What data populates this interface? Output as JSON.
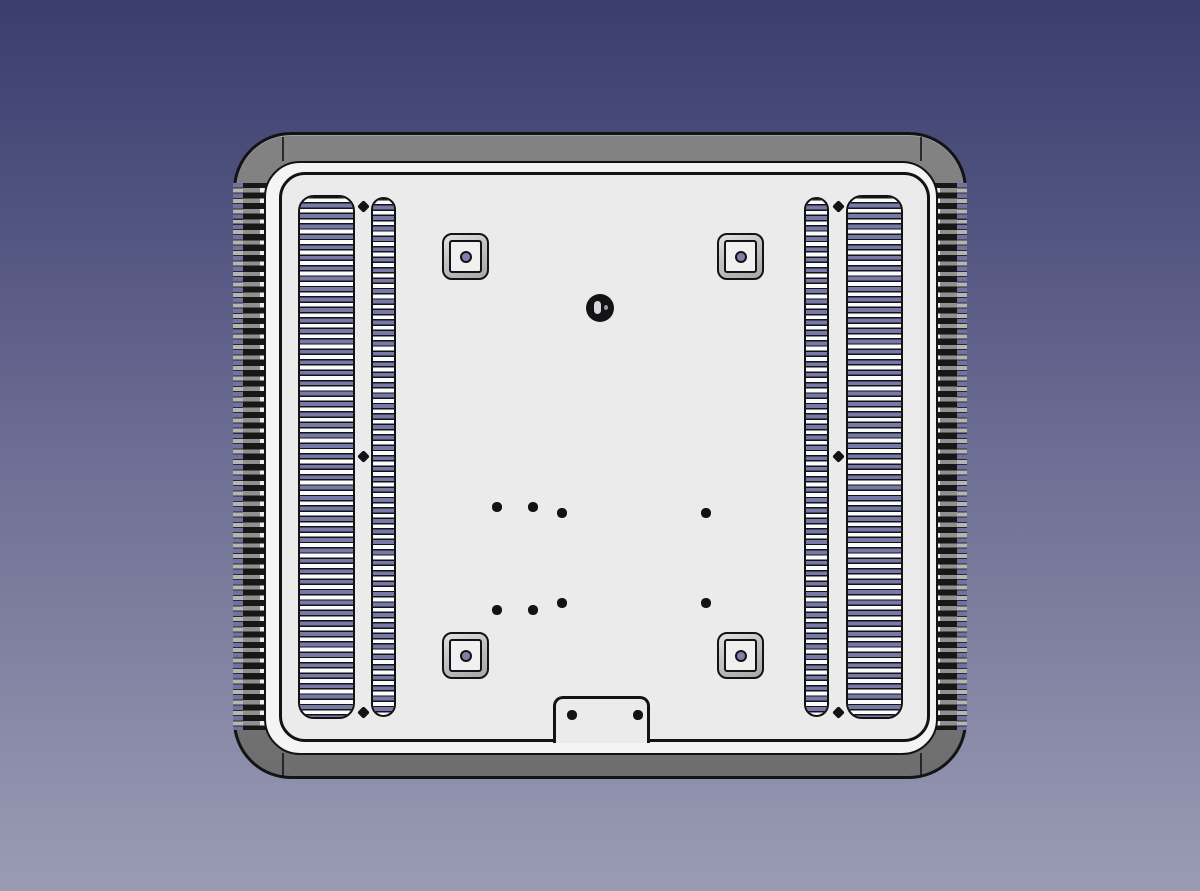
{
  "app": {
    "name": "3D CAD viewport",
    "view": "orthographic rear view of a vented equipment backplate / heatsink enclosure panel",
    "visible_text": "none"
  },
  "colors": {
    "bg-top": "#3b3d6d",
    "bg-mid": "#6b6d93",
    "bg-bottom": "#9a9bb3",
    "outline": "#131316",
    "frame-hi": "#828283",
    "frame-lo": "#6e6e6f",
    "rim": "#f4f4f5",
    "face": "#ebebec",
    "vent-purple": "#777aa8",
    "vent-white": "#fbfbfc",
    "fin-dark": "#171717",
    "fin-gray": "#909090",
    "fin-bright": "#ececec",
    "fin-bg-purple": "#70739f",
    "hole-dark": "#131316",
    "boss-hole": "#817fab"
  },
  "scene": {
    "part": "rounded-rectangle gray panel with dark edge outlines",
    "features": {
      "heatsink_fin_bands": 2,
      "vent_slot_columns": 4,
      "vent_column_layout": "wide + narrow pair on each side",
      "diamond_screw_holes_between_columns": 6,
      "chamfered_square_bosses_with_center_hole": 4,
      "center_pivot_screw": 1,
      "small_mounting_holes": 8,
      "bottom_cable_clamp_notch_with_holes": 1
    }
  }
}
